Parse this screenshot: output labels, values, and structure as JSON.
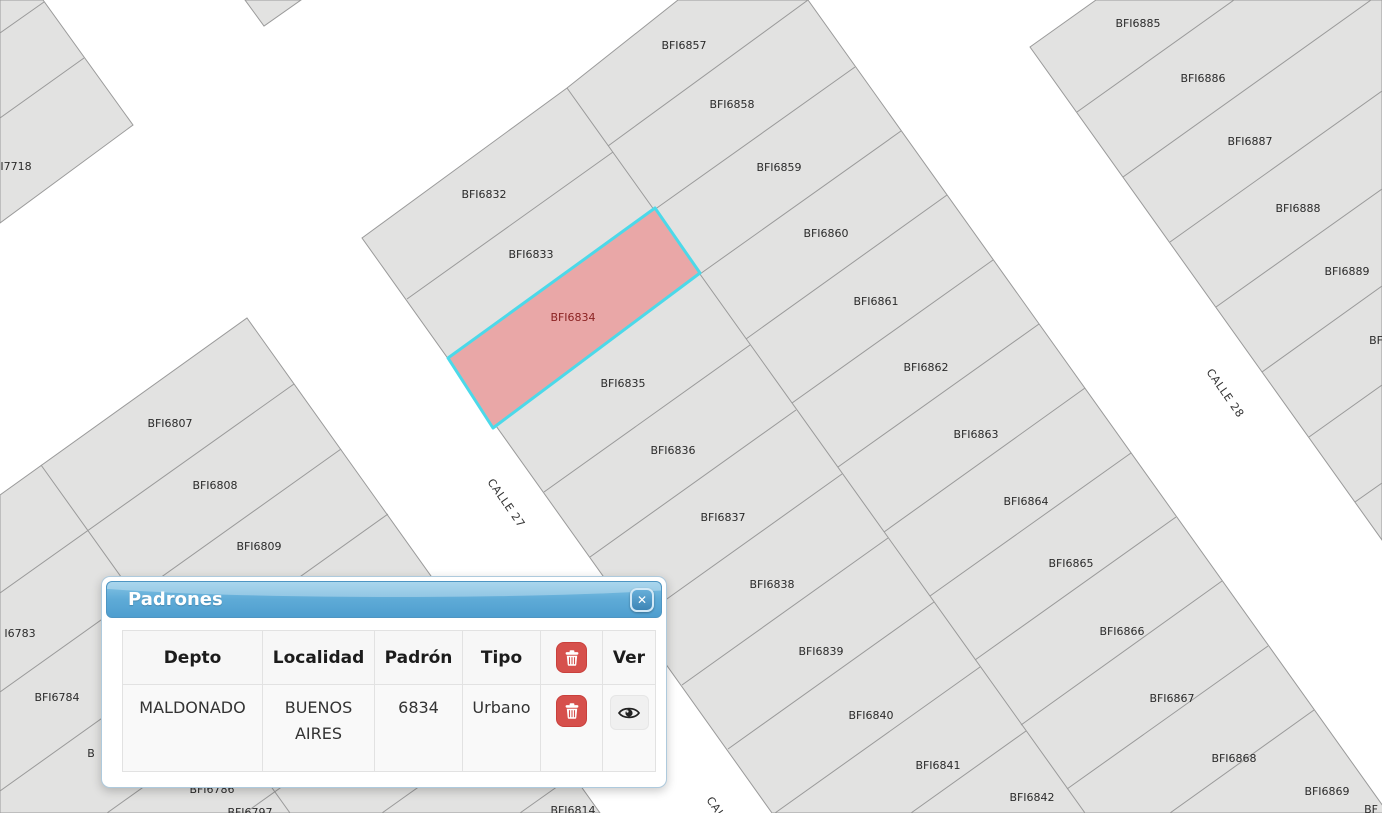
{
  "map": {
    "background": "#ffffff",
    "parcel_fill": "#e2e2e1",
    "parcel_border": "#9a9a9a",
    "label_color": "#2b2b2b",
    "selected_parcel": {
      "label": "BFI6834",
      "fill": "#e9a7a7",
      "border": "#4cd9e9",
      "label_color": "#8b2222"
    },
    "parcel_labels": [
      {
        "text": "BFI6857",
        "x": 684,
        "y": 45
      },
      {
        "text": "BFI6858",
        "x": 732,
        "y": 104
      },
      {
        "text": "BFI6859",
        "x": 779,
        "y": 167
      },
      {
        "text": "BFI6860",
        "x": 826,
        "y": 233
      },
      {
        "text": "BFI6861",
        "x": 876,
        "y": 301
      },
      {
        "text": "BFI6862",
        "x": 926,
        "y": 367
      },
      {
        "text": "BFI6863",
        "x": 976,
        "y": 434
      },
      {
        "text": "BFI6864",
        "x": 1026,
        "y": 501
      },
      {
        "text": "BFI6865",
        "x": 1071,
        "y": 563
      },
      {
        "text": "BFI6866",
        "x": 1122,
        "y": 631
      },
      {
        "text": "BFI6867",
        "x": 1172,
        "y": 698
      },
      {
        "text": "BFI6868",
        "x": 1234,
        "y": 758
      },
      {
        "text": "BFI6869",
        "x": 1327,
        "y": 791
      },
      {
        "text": "BFI6832",
        "x": 484,
        "y": 194
      },
      {
        "text": "BFI6833",
        "x": 531,
        "y": 254
      },
      {
        "text": "BFI6834",
        "x": 573,
        "y": 317,
        "selected": true
      },
      {
        "text": "BFI6835",
        "x": 623,
        "y": 383
      },
      {
        "text": "BFI6836",
        "x": 673,
        "y": 450
      },
      {
        "text": "BFI6837",
        "x": 723,
        "y": 517
      },
      {
        "text": "BFI6838",
        "x": 772,
        "y": 584
      },
      {
        "text": "BFI6839",
        "x": 821,
        "y": 651
      },
      {
        "text": "BFI6840",
        "x": 871,
        "y": 715
      },
      {
        "text": "BFI6841",
        "x": 938,
        "y": 765
      },
      {
        "text": "BFI6842",
        "x": 1032,
        "y": 797
      },
      {
        "text": "BFI6885",
        "x": 1138,
        "y": 23
      },
      {
        "text": "BFI6886",
        "x": 1203,
        "y": 78
      },
      {
        "text": "BFI6887",
        "x": 1250,
        "y": 141
      },
      {
        "text": "BFI6888",
        "x": 1298,
        "y": 208
      },
      {
        "text": "BFI6889",
        "x": 1347,
        "y": 271
      },
      {
        "text": "BF",
        "x": 1376,
        "y": 340
      },
      {
        "text": "BFI6807",
        "x": 170,
        "y": 423
      },
      {
        "text": "BFI6808",
        "x": 215,
        "y": 485
      },
      {
        "text": "BFI6809",
        "x": 259,
        "y": 546
      },
      {
        "text": "I6783",
        "x": 20,
        "y": 633
      },
      {
        "text": "BFI6784",
        "x": 57,
        "y": 697
      },
      {
        "text": "B",
        "x": 91,
        "y": 753
      },
      {
        "text": "BFI6786",
        "x": 212,
        "y": 789
      },
      {
        "text": "BFI6797",
        "x": 250,
        "y": 812
      },
      {
        "text": "BFI6814",
        "x": 573,
        "y": 810
      },
      {
        "text": "I7718",
        "x": 16,
        "y": 166
      },
      {
        "text": "BF",
        "x": 1371,
        "y": 809
      }
    ],
    "street_labels": [
      {
        "text": "CALLE 27",
        "x": 487,
        "y": 482,
        "angle": 55
      },
      {
        "text": "CALLE 28",
        "x": 1206,
        "y": 372,
        "angle": 55
      },
      {
        "text": "CALLE 27",
        "x": 706,
        "y": 800,
        "angle": 55
      }
    ]
  },
  "popup": {
    "title": "Padrones",
    "close_glyph": "✕",
    "table": {
      "headers": {
        "depto": "Depto",
        "localidad": "Localidad",
        "padron": "Padrón",
        "tipo": "Tipo",
        "ver": "Ver"
      },
      "rows": [
        {
          "depto": "MALDONADO",
          "localidad": "BUENOS AIRES",
          "padron": "6834",
          "tipo": "Urbano"
        }
      ]
    }
  }
}
